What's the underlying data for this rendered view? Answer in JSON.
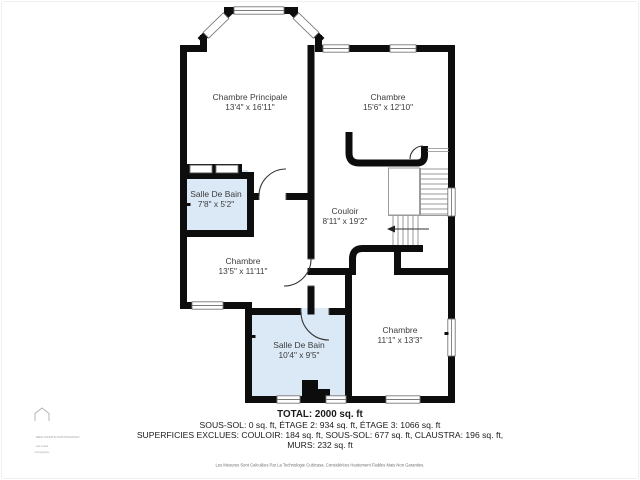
{
  "rooms": [
    {
      "name": "Chambre Principale",
      "dims": "13'4\" x 16'11\""
    },
    {
      "name": "Chambre",
      "dims": "15'6\" x 12'10\""
    },
    {
      "name": "Salle De Bain",
      "dims": "7'8\" x 5'2\""
    },
    {
      "name": "Couloir",
      "dims": "8'11\" x 19'2\""
    },
    {
      "name": "Chambre",
      "dims": "13'5\" x 11'11\""
    },
    {
      "name": "Salle De Bain",
      "dims": "10'4\" x 9'5\""
    },
    {
      "name": "Chambre",
      "dims": "11'1\" x 13'3\""
    }
  ],
  "summary": {
    "total": "TOTAL: 2000 sq. ft",
    "line2": "SOUS-SOL: 0 sq. ft, ÉTAGE 2: 934 sq. ft, ÉTAGE 3: 1066 sq. ft",
    "line3": "SUPERFICIES EXCLUES: COULOIR: 184 sq. ft, SOUS-SOL: 677 sq. ft, CLAUSTRA: 196 sq. ft,",
    "line4": "MURS: 232 sq. ft",
    "disclaimer": "Les Mesures Sont Calculées Par La Technologie Cubicasa. Considérées Hautement Fiables Mais Non Garanties."
  },
  "watermark": {
    "icon": "house-outline-icon",
    "line1": "REAL ESTATE PHOTOGRAPHY",
    "line2": "real estate",
    "line3": "photography"
  },
  "stairs": {
    "direction_arrow": "left-arrow"
  },
  "colors": {
    "wall": "#0d0d0d",
    "bathroom_fill": "#dbe9f6",
    "window_border": "#7a7a7a",
    "stair_tread": "#9a9a9a",
    "label_text": "#3c3c3c"
  }
}
